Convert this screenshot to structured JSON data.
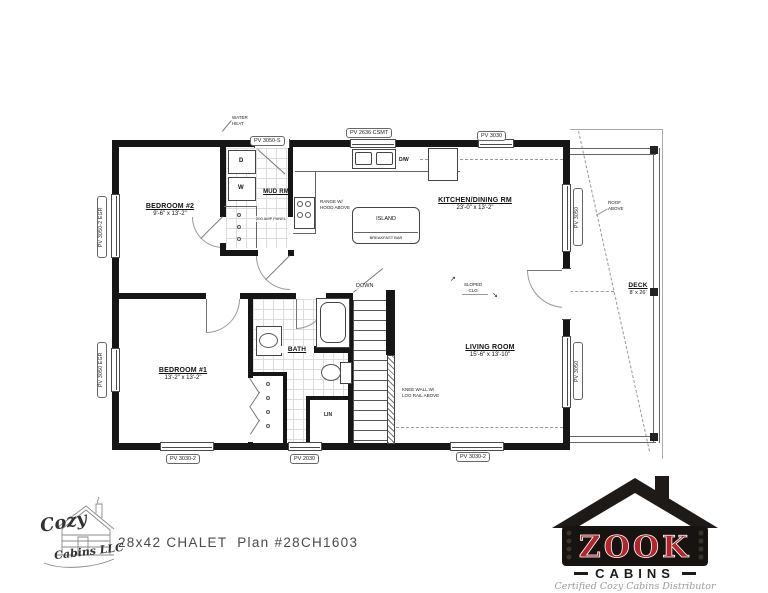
{
  "title_block": {
    "plan_title": "28x42 CHALET  Plan #28CH1603"
  },
  "rooms": {
    "bedroom2": {
      "name": "BEDROOM #2",
      "dims": "9'-6\" x 13'-2\""
    },
    "mud": {
      "name": "MUD RM"
    },
    "kitchen": {
      "name": "KITCHEN/DINING RM",
      "dims": "23'-0\" x 13'-2\""
    },
    "bedroom1": {
      "name": "BEDROOM #1",
      "dims": "13'-2\" x 13'-2\""
    },
    "bath": {
      "name": "BATH"
    },
    "living": {
      "name": "LIVING ROOM",
      "dims": "15'-6\" x 13'-10\""
    },
    "deck": {
      "name": "DECK",
      "dims": "8' x 26'"
    },
    "lin": {
      "name": "LIN"
    }
  },
  "appliances": {
    "dryer": "D",
    "washer": "W",
    "dishwasher": "D/W",
    "island": "ISLAND",
    "breakfast_bar": "BREAKFAST BAR"
  },
  "windows": {
    "top_left": "PV 3050-S",
    "top_mid": "PV 2636 CSMT",
    "top_right": "PV 3030",
    "bottom_left": "PV 3030-2",
    "bottom_mid": "PV 2030",
    "bottom_right": "PV 3030-2",
    "left_top": "PV 3050-2 EGR",
    "left_bottom": "PV 3050 EGR",
    "right_top": "PV 3050",
    "right_bottom": "PV 3050"
  },
  "annotations": {
    "water_heater_1": "WATER",
    "water_heater_2": "HEAT",
    "amp_panel": "200 AMP PANEL",
    "range_1": "RANGE W/",
    "range_2": "HOOD ABOVE",
    "down": "DOWN",
    "knee_wall_1": "KNEE WALL W/",
    "knee_wall_2": "LOG RAIL ABOVE",
    "slope_1": "SLOPED",
    "slope_2": "CLG",
    "slope_arrow_up": "↗",
    "slope_arrow_down": "↘",
    "roof_1": "ROOF",
    "roof_2": "ABOVE"
  },
  "logos": {
    "cozy": {
      "word1": "Cozy",
      "word2": "Cabins LLC"
    },
    "zook": {
      "name": "ZOOK",
      "word": "CABINS",
      "tagline": "Certified Cozy Cabins Distributor",
      "red": "#b3242b"
    }
  }
}
